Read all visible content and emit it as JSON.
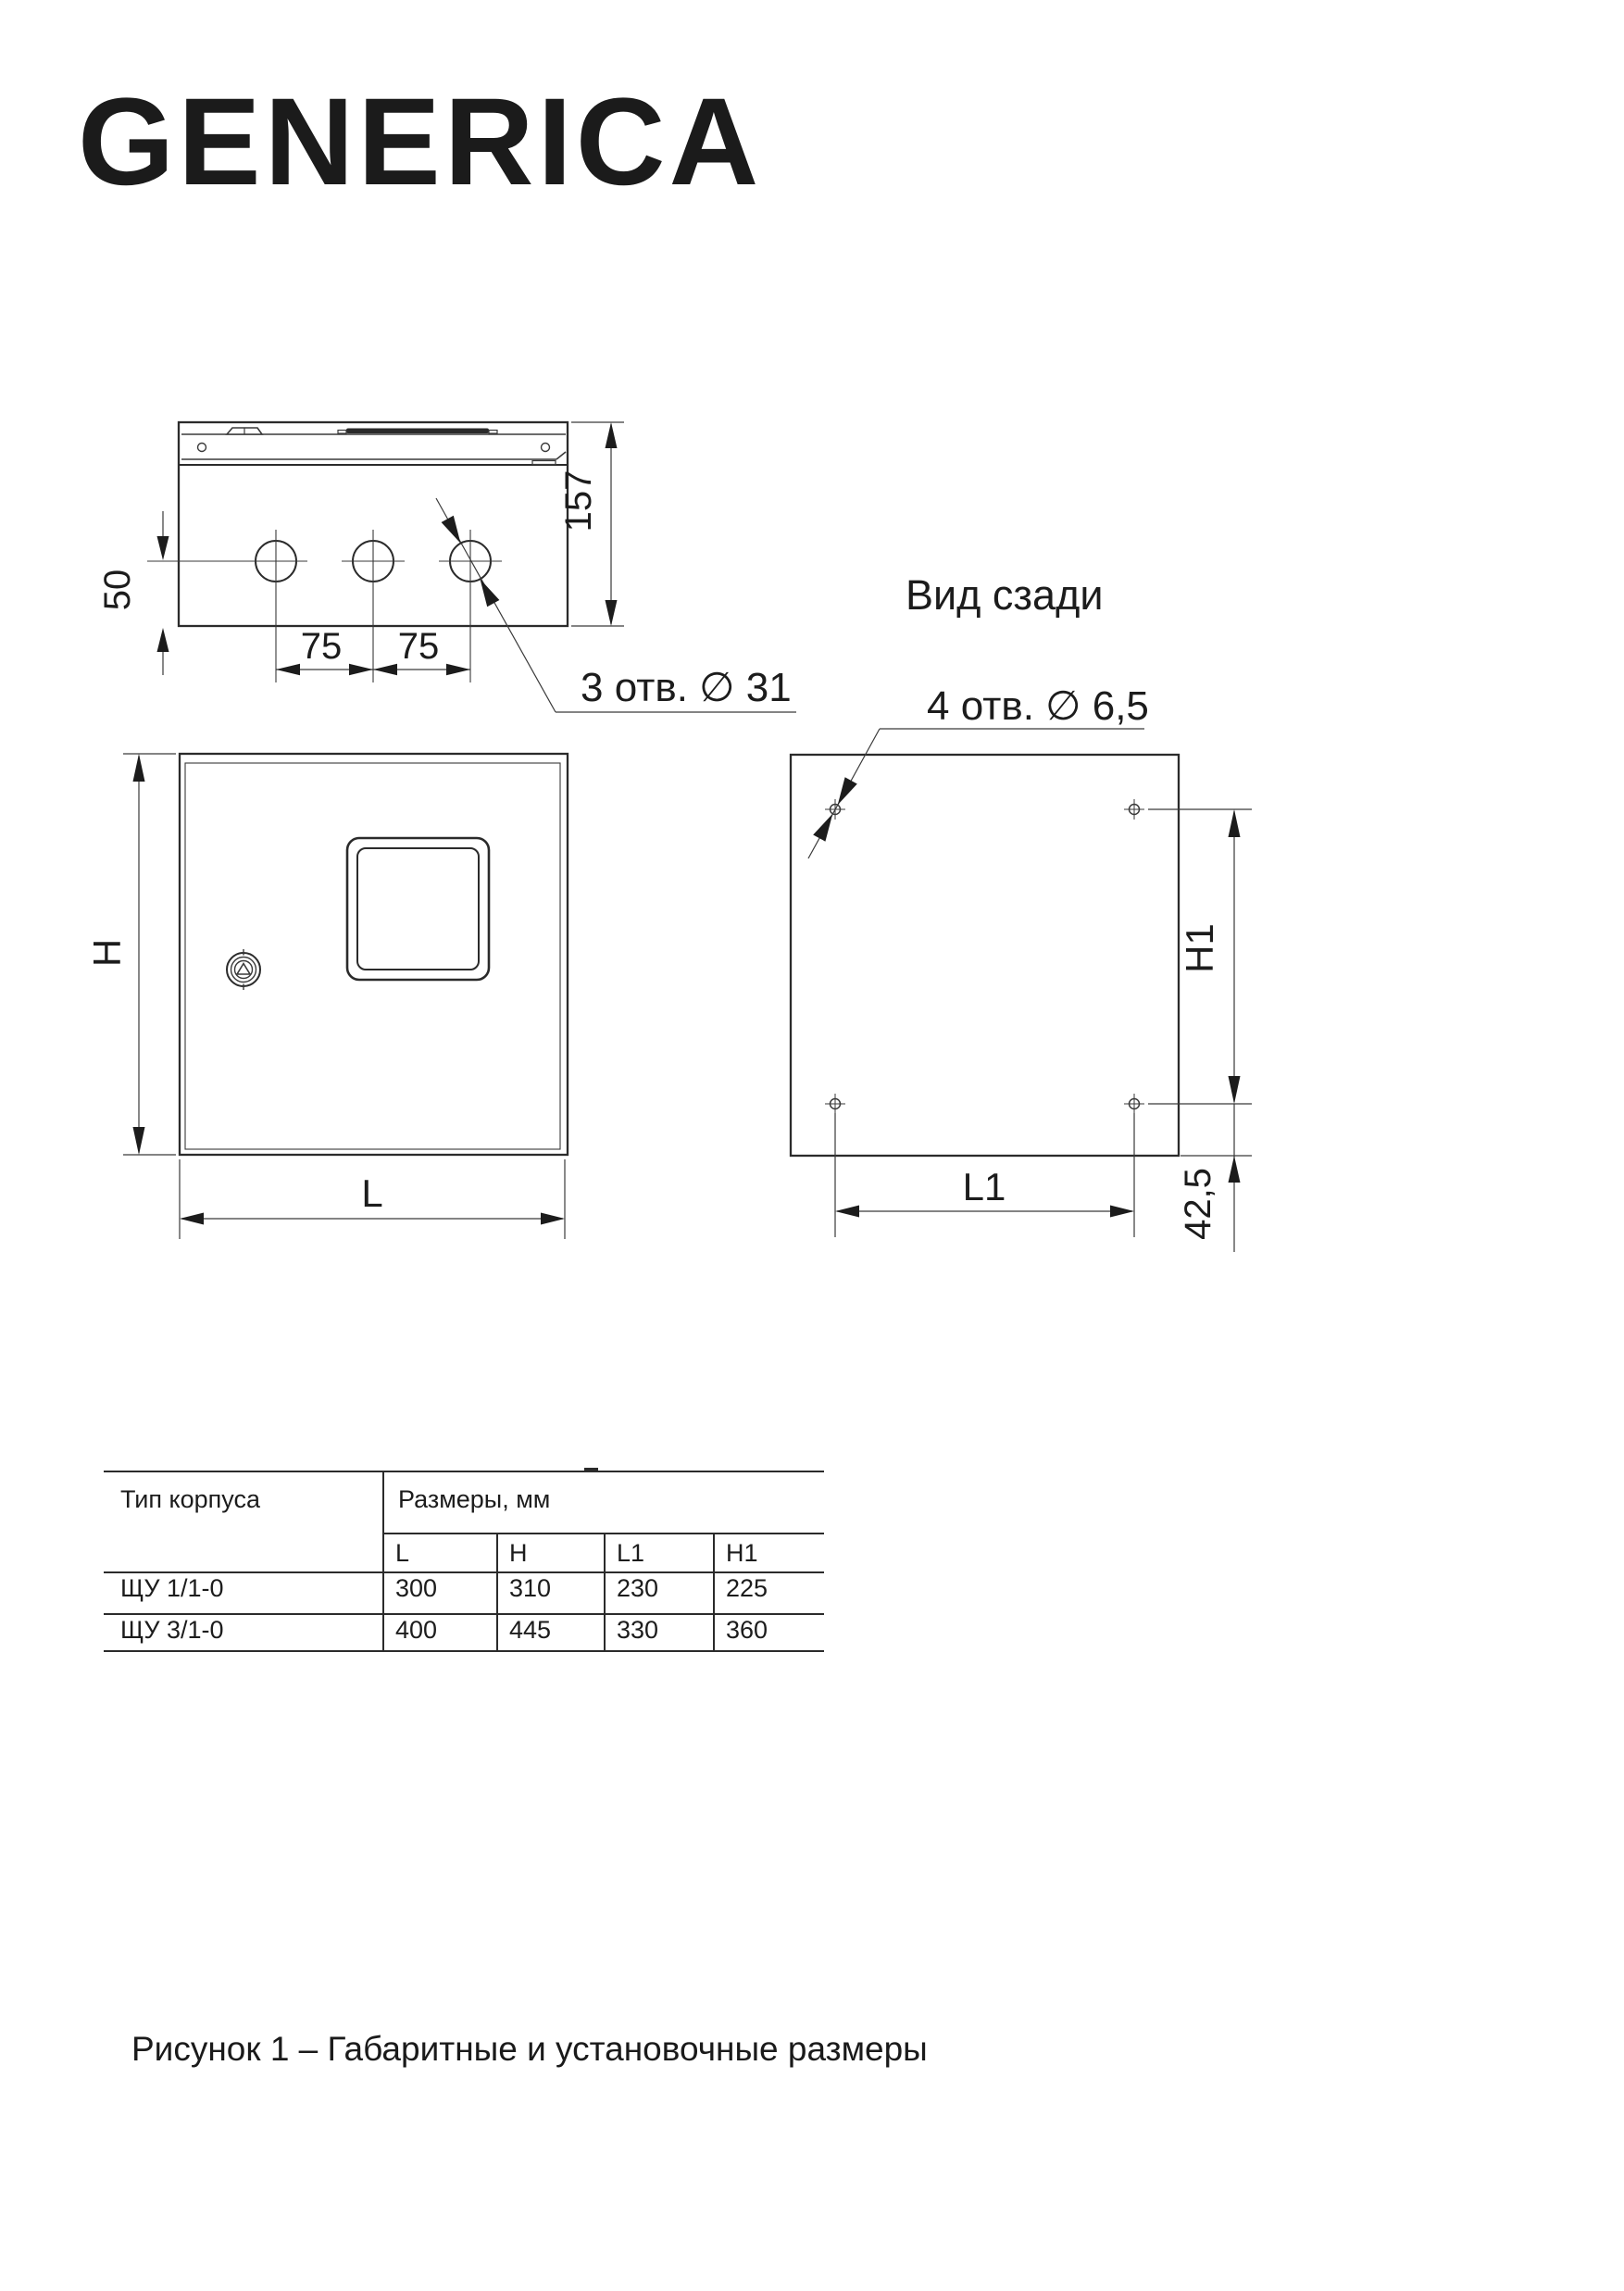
{
  "logo": {
    "text": "GENERICA"
  },
  "drawing": {
    "top_view": {
      "dim_depth": "157",
      "dim_hole_offset": "50",
      "dim_spacing_a": "75",
      "dim_spacing_b": "75",
      "holes_label": "3 отв.  ∅ 31"
    },
    "front_view": {
      "dim_h": "H",
      "dim_l": "L"
    },
    "rear_view": {
      "title": "Вид сзади",
      "holes_label": "4 отв. ∅ 6,5",
      "dim_h1": "H1",
      "dim_l1": "L1",
      "dim_bottom_offset": "42,5"
    }
  },
  "table": {
    "col1_header": "Тип корпуса",
    "col2_header": "Размеры, мм",
    "sub_headers": [
      "L",
      "H",
      "L1",
      "H1"
    ],
    "rows": [
      {
        "type": "ЩУ 1/1-0",
        "values": [
          "300",
          "310",
          "230",
          "225"
        ]
      },
      {
        "type": "ЩУ 3/1-0",
        "values": [
          "400",
          "445",
          "330",
          "360"
        ]
      }
    ]
  },
  "caption": {
    "text": "Рисунок 1 – Габаритные и установочные размеры"
  },
  "colors": {
    "line": "#2b2b2b",
    "text": "#1c1c1c"
  }
}
